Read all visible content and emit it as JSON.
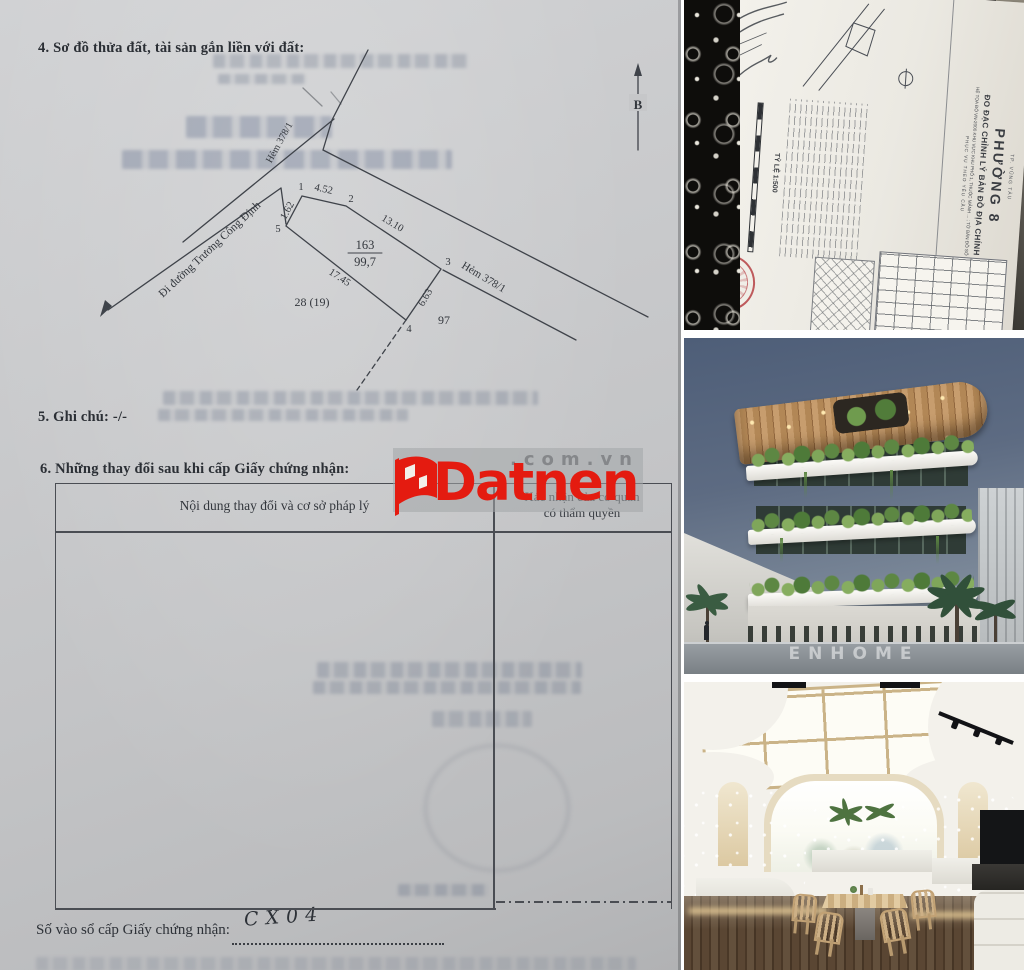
{
  "page": {
    "background": "#ffffff"
  },
  "certificate_page": {
    "paper_color": "#c7c8ca",
    "section4_heading": "4. Sơ đồ thửa đất, tài sản gắn liền với đất:",
    "section5_heading": "5. Ghi chú: -/-",
    "section6_heading": "6. Những thay đổi sau khi cấp Giấy chứng nhận:",
    "changes_table": {
      "col1_header": "Nội dung thay đổi và cơ sở pháp lý",
      "col2_header_line1": "Xác nhận của cơ quan",
      "col2_header_line2": "có thẩm quyền"
    },
    "registry_line": {
      "label": "Số vào sổ cấp Giấy chứng nhận:",
      "handwritten_value": "CX04"
    },
    "plot_diagram": {
      "north_label": "B",
      "road_label": "Đi đường Trương Công Định",
      "alley_label_top": "Hẻm 378/1",
      "alley_label_right": "Hẻm 378/1",
      "parcel_number": "163",
      "parcel_area": "99,7",
      "edge_12": "4.52",
      "edge_23": "13.10",
      "edge_34": "6.63",
      "edge_45": "17.45",
      "edge_51": "1.62",
      "vertex_1": "1",
      "vertex_2": "2",
      "vertex_3": "3",
      "vertex_4": "4",
      "vertex_5": "5",
      "adjacent_parcel_left": "28 (19)",
      "adjacent_parcel_right": "97"
    }
  },
  "watermark": {
    "brand": "Datnen",
    "suffix": ".com.vn",
    "red": "#e41b10",
    "gray": "#85878a"
  },
  "photo_cadastral": {
    "district_line": "TP. VŨNG TÀU",
    "ward_title": "PHƯỜNG 8",
    "subtitle": "ĐO ĐẠC CHỈNH LÝ BẢN ĐỒ ĐỊA CHÍNH",
    "coordinate_line": "HỆ TỌA ĐỘ VN-2000 KHU VỰC KHU PHỐ 1, THUỘC MẢNH ... ; TỜ BẢN ĐỒ SỐ 20",
    "purpose_line": "PHỤC VỤ THEO YÊU CẦU",
    "scale_label": "TỶ LỆ 1:500"
  },
  "photo_building": {
    "watermark": "ENHOME",
    "sky_color": "#5a6780"
  },
  "photo_interior": {
    "floor_color": "#52402e",
    "frame_color": "#cab387"
  }
}
